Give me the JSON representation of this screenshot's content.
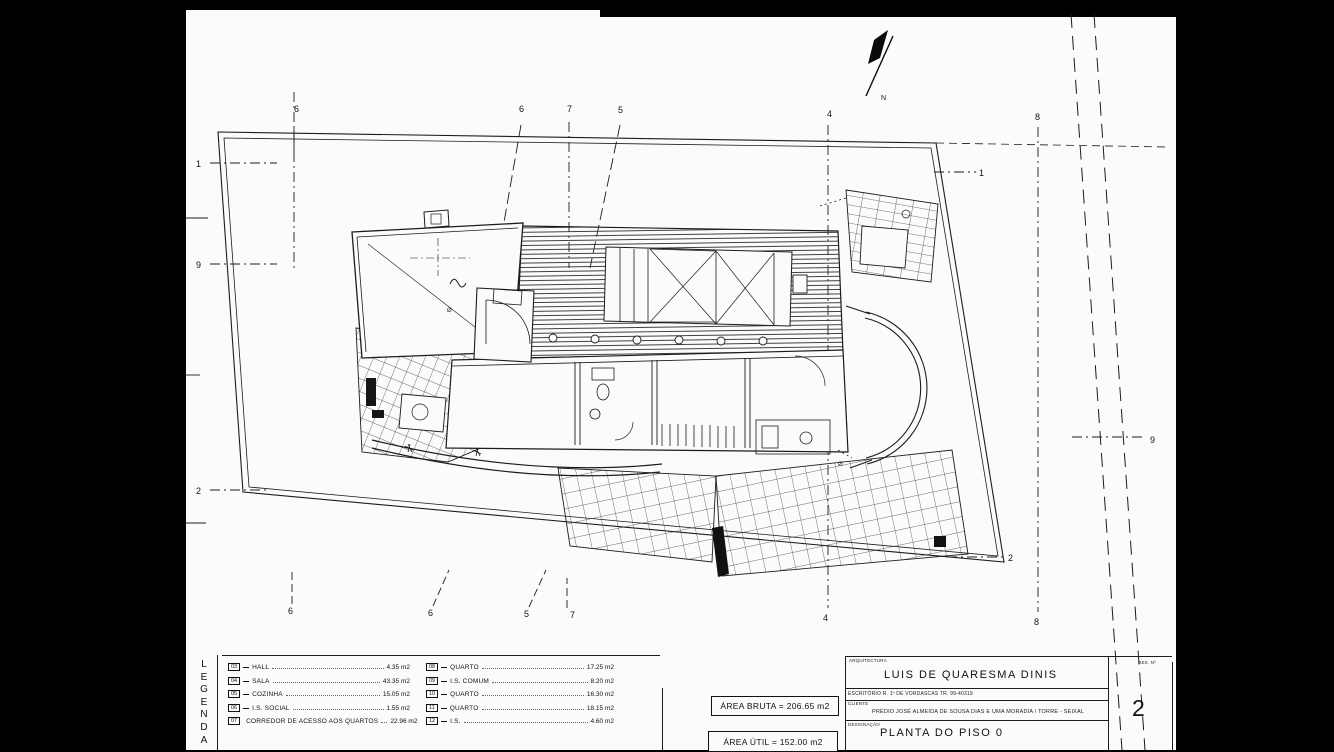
{
  "colors": {
    "paper": "#fbfbfb",
    "ink": "#1c1c1c",
    "frame_bar": "#000000"
  },
  "plan": {
    "north_label": "N",
    "grid_markers": {
      "top": [
        "6",
        "6",
        "7",
        "5",
        "4",
        "8"
      ],
      "bottom": [
        "6",
        "6",
        "5",
        "7",
        "4",
        "8"
      ],
      "left": [
        "1",
        "9",
        "2"
      ],
      "right": [
        "1",
        "9",
        "2"
      ]
    },
    "annotations": {
      "diameter_1": "Ø",
      "diameter_2": "Ø"
    }
  },
  "legend": {
    "title_letters": [
      "L",
      "E",
      "G",
      "E",
      "N",
      "D",
      "A"
    ],
    "left_items": [
      {
        "num": "03",
        "label": "HALL",
        "value": "4.35 m2"
      },
      {
        "num": "04",
        "label": "SALA",
        "value": "43.35 m2"
      },
      {
        "num": "05",
        "label": "COZINHA",
        "value": "15.05 m2"
      },
      {
        "num": "06",
        "label": "I.S. SOCIAL",
        "value": "1.55 m2"
      },
      {
        "num": "07",
        "label": "CORREDOR DE ACESSO AOS QUARTOS",
        "value": "22.96 m2"
      }
    ],
    "right_items": [
      {
        "num": "08",
        "label": "QUARTO",
        "value": "17.25 m2"
      },
      {
        "num": "09",
        "label": "I.S. COMUM",
        "value": "8.20 m2"
      },
      {
        "num": "10",
        "label": "QUARTO",
        "value": "16.30 m2"
      },
      {
        "num": "11",
        "label": "QUARTO",
        "value": "18.15 m2"
      },
      {
        "num": "12",
        "label": "I.S.",
        "value": "4.60 m2"
      }
    ]
  },
  "areas": {
    "bruta": "ÁREA BRUTA = 206.65 m2",
    "util": "ÁREA ÚTIL = 152.00 m2"
  },
  "title_block": {
    "discipline_label": "ARQUITECTURA",
    "architect": "LUIS DE QUARESMA DINIS",
    "office_line": "ESCRITÓRIO   R. 1º DE VORDASCAS   TR. 99-40319",
    "client_label": "CLIENTE",
    "client_line": "PRÉDIO JOSÉ ALMEIDA DE SOUSA DIAS E UMA MORADIA / TORRE - SEIXAL",
    "designation_label": "DESIGNAÇÃO",
    "designation": "PLANTA DO PISO 0",
    "sheet_label": "DES. Nº",
    "sheet_number": "2"
  }
}
